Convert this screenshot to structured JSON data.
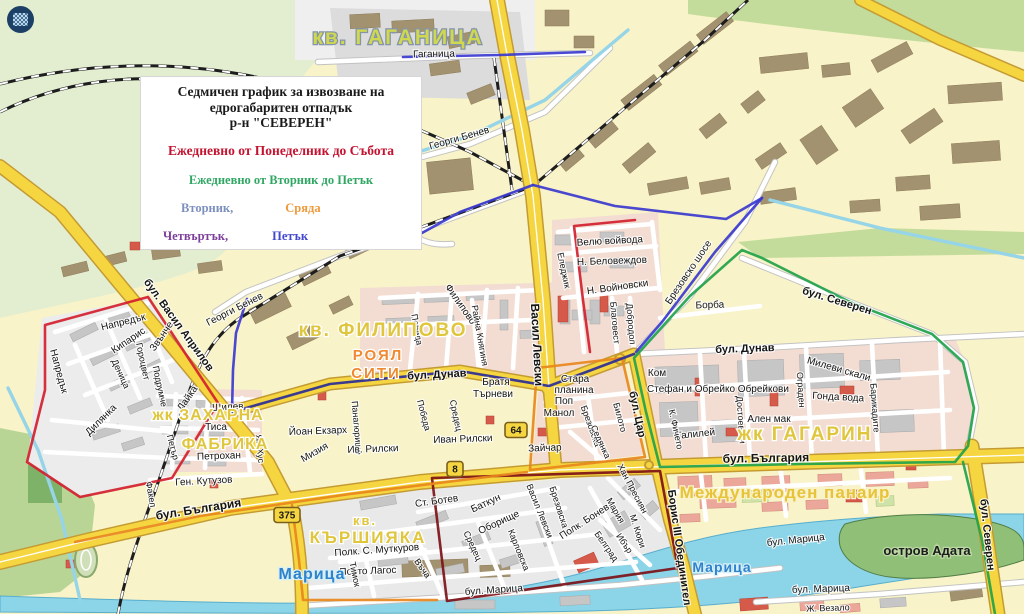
{
  "legend": {
    "title_line1": "Седмичен график за извозване на",
    "title_line2": "едрогабаритен отпадък",
    "title_line3": "р-н \"СЕВЕРЕН\"",
    "daily_mon_sat": "Ежедневно от Понеделник до Събота",
    "daily_tue_fri": "Ежедневно от Вторник до Петък",
    "tuesday": "Вторник,",
    "wednesday": "Сряда",
    "thursday": "Четвъртък,",
    "friday": "Петък",
    "colors": {
      "mon_sat": "#c41330",
      "tue_fri": "#2fa763",
      "tuesday": "#7d90bd",
      "wednesday": "#ee9a3c",
      "thursday": "#7d3f9b",
      "friday": "#4348cf"
    }
  },
  "map": {
    "base_colors": {
      "land": "#f8f3c8",
      "water": "#8cd4e8",
      "park": "#b9d596",
      "field": "#c3dc9b",
      "road_major": "#f6d640",
      "residential": "#f3ddd2"
    },
    "area_labels": [
      {
        "t": "кв. ГАГАНИЦА",
        "x": 398,
        "y": 44,
        "s": 21,
        "fill": "#cfd84e",
        "halo": "#8494ab",
        "ls": 2
      },
      {
        "t": "кв. ФИЛИПОВО",
        "x": 383,
        "y": 336,
        "s": 19,
        "fill": "#dfc63c",
        "halo": "#ffffff",
        "ls": 2
      },
      {
        "t": "РОЯЛ",
        "x": 378,
        "y": 360,
        "s": 15,
        "fill": "#ef8a31",
        "halo": "#ffffff",
        "ls": 2
      },
      {
        "t": "СИТИ",
        "x": 376,
        "y": 378,
        "s": 15,
        "fill": "#ef8a31",
        "halo": "#ffffff",
        "ls": 2
      },
      {
        "t": "жк ЗАХАРНА",
        "x": 208,
        "y": 420,
        "s": 16,
        "fill": "#dfc63c",
        "halo": "#ffffff",
        "ls": 1
      },
      {
        "t": "ФАБРИКА",
        "x": 225,
        "y": 449,
        "s": 16,
        "fill": "#dfc63c",
        "halo": "#ffffff",
        "ls": 1
      },
      {
        "t": "жк  ГАГАРИН",
        "x": 805,
        "y": 440,
        "s": 19,
        "fill": "#dfc63c",
        "halo": "#ffffff",
        "ls": 2
      },
      {
        "t": "кв.",
        "x": 365,
        "y": 525,
        "s": 13,
        "fill": "#dfc63c",
        "halo": "#ffffff",
        "ls": 2
      },
      {
        "t": "КЪРШИЯКА",
        "x": 368,
        "y": 543,
        "s": 17,
        "fill": "#dfc63c",
        "halo": "#ffffff",
        "ls": 2
      },
      {
        "t": "Международен панаир",
        "x": 785,
        "y": 498,
        "s": 17,
        "fill": "#e7c33a",
        "halo": "#faf2c8",
        "ls": 1
      },
      {
        "t": "Марица",
        "x": 312,
        "y": 579,
        "s": 16,
        "fill": "#2f82cc",
        "halo": "#d6f0f8",
        "ls": 1
      },
      {
        "t": "Марица",
        "x": 722,
        "y": 572,
        "s": 14,
        "fill": "#2f82cc",
        "halo": "#d6f0f8",
        "ls": 1
      },
      {
        "t": "остров Адата",
        "x": 927,
        "y": 555,
        "s": 13,
        "fill": "#1c1c1c",
        "halo": "#bcd8a4",
        "ls": 0
      }
    ],
    "street_labels": [
      {
        "t": "Гаганица",
        "x": 434,
        "y": 57,
        "r": -1,
        "s": 10
      },
      {
        "t": "Георги Бенев",
        "x": 460,
        "y": 141,
        "r": -16,
        "s": 10
      },
      {
        "t": "Георги Бенев",
        "x": 236,
        "y": 312,
        "r": -27,
        "s": 10
      },
      {
        "t": "Велю войвода",
        "x": 610,
        "y": 244,
        "r": -3,
        "s": 10
      },
      {
        "t": "Н. Беловеждов",
        "x": 612,
        "y": 264,
        "r": -2,
        "s": 10
      },
      {
        "t": "Н. Войновски",
        "x": 618,
        "y": 290,
        "r": -8,
        "s": 10
      },
      {
        "t": "Еледжик",
        "x": 561,
        "y": 271,
        "r": 78,
        "s": 9
      },
      {
        "t": "Благовест",
        "x": 612,
        "y": 323,
        "r": 85,
        "s": 9
      },
      {
        "t": "Добродол",
        "x": 628,
        "y": 324,
        "r": 85,
        "s": 9
      },
      {
        "t": "Брезовско шосе",
        "x": 691,
        "y": 274,
        "r": -56,
        "s": 10
      },
      {
        "t": "Борба",
        "x": 710,
        "y": 308,
        "r": -2,
        "s": 10
      },
      {
        "t": "бул. Дунав",
        "x": 745,
        "y": 352,
        "r": -2,
        "s": 11,
        "b": 1
      },
      {
        "t": "бул. Северен",
        "x": 836,
        "y": 304,
        "r": 17,
        "s": 11,
        "b": 1
      },
      {
        "t": "Милеви скали",
        "x": 838,
        "y": 372,
        "r": 16,
        "s": 10
      },
      {
        "t": "Ком",
        "x": 657,
        "y": 376,
        "r": 0,
        "s": 10
      },
      {
        "t": "Стефан и Обрейко Обрейкови",
        "x": 718,
        "y": 392,
        "r": 0,
        "s": 10
      },
      {
        "t": "Ограден",
        "x": 798,
        "y": 390,
        "r": 86,
        "s": 9
      },
      {
        "t": "Гонда вода",
        "x": 838,
        "y": 400,
        "r": 3,
        "s": 10
      },
      {
        "t": "Ален мак",
        "x": 769,
        "y": 422,
        "r": 0,
        "s": 10
      },
      {
        "t": "Достоевски",
        "x": 738,
        "y": 420,
        "r": 86,
        "s": 9
      },
      {
        "t": "Галилей",
        "x": 696,
        "y": 437,
        "r": -6,
        "s": 10
      },
      {
        "t": "К. Фичето",
        "x": 673,
        "y": 430,
        "r": 78,
        "s": 9
      },
      {
        "t": "Барикадите",
        "x": 872,
        "y": 408,
        "r": 86,
        "s": 9
      },
      {
        "t": "бул. България",
        "x": 199,
        "y": 513,
        "r": -9,
        "s": 12,
        "b": 1
      },
      {
        "t": "бул. България",
        "x": 766,
        "y": 462,
        "r": -1,
        "s": 12,
        "b": 1
      },
      {
        "t": "Борис III  Обединител",
        "x": 676,
        "y": 548,
        "r": 82,
        "s": 11,
        "b": 1
      },
      {
        "t": "бул. Цар",
        "x": 634,
        "y": 415,
        "r": 78,
        "s": 11,
        "b": 1
      },
      {
        "t": "Васил Левски",
        "x": 533,
        "y": 345,
        "r": 87,
        "s": 12,
        "b": 1
      },
      {
        "t": "бул. Васил Априлов",
        "x": 176,
        "y": 327,
        "r": 54,
        "s": 11,
        "b": 1
      },
      {
        "t": "бул. Дунав",
        "x": 437,
        "y": 378,
        "r": -3,
        "s": 11,
        "b": 1
      },
      {
        "t": "бул. Северен",
        "x": 984,
        "y": 535,
        "r": 84,
        "s": 11,
        "b": 1
      },
      {
        "t": "Напредък",
        "x": 124,
        "y": 325,
        "r": -14,
        "s": 10
      },
      {
        "t": "Напредък",
        "x": 56,
        "y": 372,
        "r": 75,
        "s": 10
      },
      {
        "t": "Кипарис",
        "x": 130,
        "y": 343,
        "r": -34,
        "s": 10
      },
      {
        "t": "Звънче",
        "x": 164,
        "y": 338,
        "r": -55,
        "s": 10
      },
      {
        "t": "Гороцвет",
        "x": 140,
        "y": 362,
        "r": 78,
        "s": 9
      },
      {
        "t": "Деница",
        "x": 118,
        "y": 375,
        "r": 65,
        "s": 9
      },
      {
        "t": "Подрумче",
        "x": 157,
        "y": 387,
        "r": 78,
        "s": 9
      },
      {
        "t": "Лайка",
        "x": 190,
        "y": 400,
        "r": -55,
        "s": 10
      },
      {
        "t": "Дилянка",
        "x": 103,
        "y": 422,
        "r": -45,
        "s": 10
      },
      {
        "t": "Шилев",
        "x": 228,
        "y": 410,
        "r": -3,
        "s": 10
      },
      {
        "t": "Тиса",
        "x": 216,
        "y": 430,
        "r": 0,
        "s": 10
      },
      {
        "t": "Петрохан",
        "x": 219,
        "y": 459,
        "r": -2,
        "s": 10
      },
      {
        "t": "Ян Хус",
        "x": 257,
        "y": 449,
        "r": 85,
        "s": 9
      },
      {
        "t": "Петър",
        "x": 170,
        "y": 448,
        "r": 75,
        "s": 9
      },
      {
        "t": "Факел",
        "x": 148,
        "y": 495,
        "r": 80,
        "s": 9
      },
      {
        "t": "Ген. Кутузов",
        "x": 204,
        "y": 484,
        "r": -3,
        "s": 10
      },
      {
        "t": "Филипово",
        "x": 458,
        "y": 306,
        "r": 55,
        "s": 10
      },
      {
        "t": "Райна Княгиня",
        "x": 477,
        "y": 336,
        "r": 80,
        "s": 9
      },
      {
        "t": "Победа",
        "x": 414,
        "y": 330,
        "r": 80,
        "s": 9
      },
      {
        "t": "Победа",
        "x": 421,
        "y": 416,
        "r": 75,
        "s": 9
      },
      {
        "t": "Братя",
        "x": 496,
        "y": 385,
        "r": 0,
        "s": 10
      },
      {
        "t": "Търневи",
        "x": 493,
        "y": 397,
        "r": 0,
        "s": 10
      },
      {
        "t": "Панагюрище",
        "x": 354,
        "y": 428,
        "r": 85,
        "s": 9
      },
      {
        "t": "Йоан Екзарх",
        "x": 318,
        "y": 434,
        "r": -2,
        "s": 10
      },
      {
        "t": "Мизия",
        "x": 316,
        "y": 455,
        "r": -30,
        "s": 10
      },
      {
        "t": "Ив. Рилски",
        "x": 373,
        "y": 452,
        "r": -2,
        "s": 10
      },
      {
        "t": "Иван Рилски",
        "x": 463,
        "y": 442,
        "r": -2,
        "s": 10
      },
      {
        "t": "Средец",
        "x": 453,
        "y": 416,
        "r": 78,
        "s": 9
      },
      {
        "t": "Средец",
        "x": 470,
        "y": 547,
        "r": 65,
        "s": 9
      },
      {
        "t": "Стара",
        "x": 575,
        "y": 382,
        "r": 0,
        "s": 10
      },
      {
        "t": "планина",
        "x": 574,
        "y": 393,
        "r": 0,
        "s": 10
      },
      {
        "t": "Поп",
        "x": 564,
        "y": 404,
        "r": 0,
        "s": 10
      },
      {
        "t": "Манол",
        "x": 559,
        "y": 416,
        "r": 0,
        "s": 10
      },
      {
        "t": "Брезовска",
        "x": 588,
        "y": 427,
        "r": 70,
        "s": 9
      },
      {
        "t": "Брезовска",
        "x": 556,
        "y": 508,
        "r": 72,
        "s": 9
      },
      {
        "t": "Седянка",
        "x": 598,
        "y": 443,
        "r": 65,
        "s": 9
      },
      {
        "t": "Билото",
        "x": 617,
        "y": 418,
        "r": 75,
        "s": 9
      },
      {
        "t": "Зайчар",
        "x": 545,
        "y": 451,
        "r": -2,
        "s": 10
      },
      {
        "t": "Ст. Ботев",
        "x": 437,
        "y": 504,
        "r": -8,
        "s": 10
      },
      {
        "t": "Баткун",
        "x": 487,
        "y": 506,
        "r": -25,
        "s": 10
      },
      {
        "t": "Оборище",
        "x": 500,
        "y": 525,
        "r": -25,
        "s": 10
      },
      {
        "t": "Карловска",
        "x": 516,
        "y": 551,
        "r": 68,
        "s": 9
      },
      {
        "t": "Васил Левски",
        "x": 537,
        "y": 512,
        "r": 68,
        "s": 9
      },
      {
        "t": "Полк. Бонев",
        "x": 586,
        "y": 524,
        "r": -33,
        "s": 10
      },
      {
        "t": "Мария",
        "x": 613,
        "y": 512,
        "r": 60,
        "s": 9
      },
      {
        "t": "Белград",
        "x": 604,
        "y": 548,
        "r": 55,
        "s": 9
      },
      {
        "t": "Ибър",
        "x": 622,
        "y": 545,
        "r": 55,
        "s": 9
      },
      {
        "t": "М. Кюри",
        "x": 635,
        "y": 532,
        "r": 72,
        "s": 9
      },
      {
        "t": "Хан Пресиян",
        "x": 630,
        "y": 490,
        "r": 62,
        "s": 9
      },
      {
        "t": "Полк. С. Муткуров",
        "x": 377,
        "y": 553,
        "r": -4,
        "s": 10
      },
      {
        "t": "Порто Лагос",
        "x": 368,
        "y": 574,
        "r": -2,
        "s": 10
      },
      {
        "t": "Тимок",
        "x": 352,
        "y": 575,
        "r": 78,
        "s": 9
      },
      {
        "t": "Въча",
        "x": 420,
        "y": 570,
        "r": 55,
        "s": 9
      },
      {
        "t": "бул. Марица",
        "x": 494,
        "y": 593,
        "r": -4,
        "s": 10
      },
      {
        "t": "бул. Марица",
        "x": 796,
        "y": 543,
        "r": -6,
        "s": 10
      },
      {
        "t": "бул. Марица",
        "x": 821,
        "y": 592,
        "r": -2,
        "s": 10
      },
      {
        "t": "Ж. Везало",
        "x": 828,
        "y": 611,
        "r": -2,
        "s": 9
      }
    ],
    "road_shields": [
      {
        "label": "64",
        "x": 516,
        "y": 430
      },
      {
        "label": "8",
        "x": 455,
        "y": 469
      },
      {
        "label": "375",
        "x": 287,
        "y": 515
      }
    ],
    "routes": [
      {
        "name": "route-red-mon-sat",
        "color": "#d2202f",
        "closed": true,
        "points": "45,325 148,297 218,403 172,478 80,497 27,462 45,390"
      },
      {
        "name": "route-red-segment",
        "color": "#d2202f",
        "closed": false,
        "points": "635,220 574,226 583,300 590,352"
      },
      {
        "name": "route-maroon-karshiaka",
        "color": "#7c1117",
        "closed": true,
        "points": "432,478 660,471 678,568 447,601"
      },
      {
        "name": "route-orange-loop",
        "color": "#e8871c",
        "closed": true,
        "points": "537,368 622,358 645,457 530,470"
      },
      {
        "name": "route-orange-bulgaria",
        "color": "#e8871c",
        "closed": false,
        "points": "75,542 200,516 350,494 527,472"
      },
      {
        "name": "route-orange-karshiaka-west",
        "color": "#e8871c",
        "closed": false,
        "points": "292,505 299,560 303,600 437,600"
      },
      {
        "name": "route-green-gagarin",
        "color": "#21a24a",
        "closed": true,
        "points": "634,358 690,296 742,250 762,258 850,302 932,334 963,362 974,408 968,446 955,462 800,464 660,467 646,412"
      },
      {
        "name": "route-green-severen",
        "color": "#21a24a",
        "closed": false,
        "points": "963,462 982,540 995,614"
      },
      {
        "name": "route-blue-gaganitsa",
        "color": "#3939cf",
        "closed": false,
        "points": "403,57 500,55 585,52"
      },
      {
        "name": "route-blue-west",
        "color": "#3939cf",
        "closed": false,
        "points": "533,185 460,212 422,233"
      },
      {
        "name": "route-blue-aprilov",
        "color": "#3939cf",
        "closed": false,
        "points": "247,299 236,333 233,370 232,412"
      },
      {
        "name": "route-blue-ne",
        "color": "#3939cf",
        "closed": false,
        "points": "533,185 615,206 726,219 762,198"
      },
      {
        "name": "route-blue-brezovsko",
        "color": "#3939cf",
        "closed": false,
        "points": "762,198 715,252 662,322 636,352"
      },
      {
        "name": "route-navy-dunav",
        "color": "#2b2d96",
        "closed": false,
        "points": "232,412 330,384 460,371 549,386 634,354"
      }
    ]
  }
}
